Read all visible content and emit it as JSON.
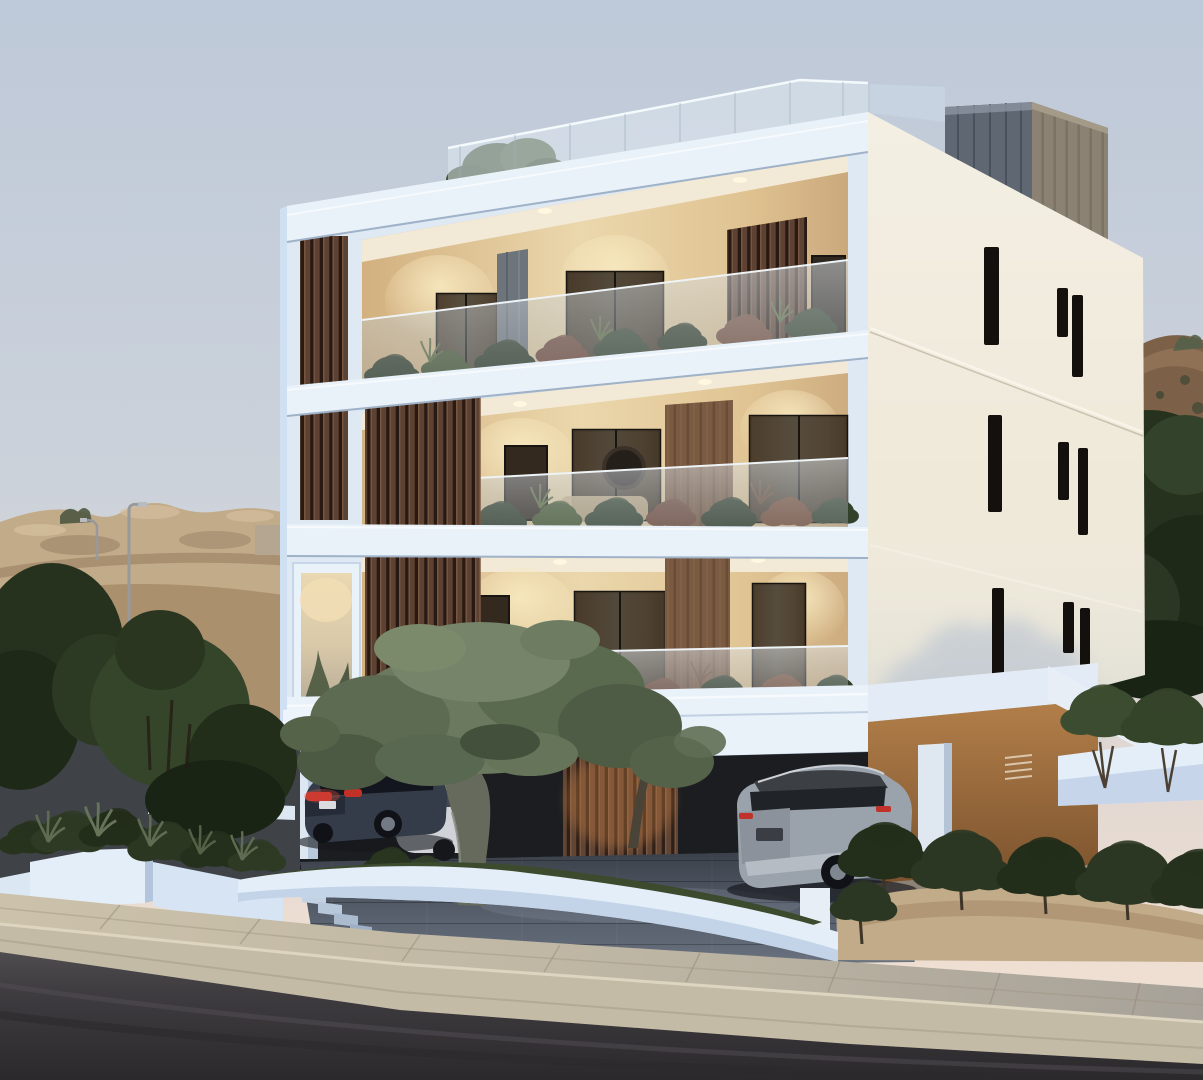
{
  "scene": {
    "type": "architectural-render",
    "description": "Dusk 3D rendering of a modern four-storey white apartment building with vertical wood-slat screens, warm-lit balconies with glass balustrades and planters, rooftop terrace with glass railing, ground-level carport with parked cars, an olive tree in a curved white planter, landscaped white retaining walls, a paved sidewalk and asphalt road on a sandy hillside.",
    "objects": [
      "apartment-building",
      "rooftop-glass-railing",
      "roof-stair-core",
      "wood-slat-screen",
      "balcony",
      "balustrade-glass",
      "balcony-plants",
      "frosted-entrance-window",
      "slit-windows",
      "carport",
      "dark-sedan",
      "white-car",
      "silver-suv",
      "olive-tree",
      "second-olive-tree",
      "white-planter-walls",
      "garden-steps",
      "street-lamp",
      "sandy-hillside",
      "rocky-hillside",
      "dark-green-trees",
      "shrub-row",
      "sand-mound",
      "sidewalk",
      "kerb",
      "asphalt-road",
      "paver-driveway"
    ]
  },
  "palette": {
    "sky_top": "#bec9d9",
    "sky_horizon": "#eedfd2",
    "facade_white": "#dfe9f4",
    "facade_band": "#e9f1f9",
    "facade_side": "#cfe0f2",
    "cream_face": "#efe9d9",
    "cream_shadow": "#b7c2d2",
    "wood_dark": "#503628",
    "wood_mid": "#6e4c38",
    "wood_pillar": "#7b5a42",
    "roofcore_front": "#5f6872",
    "roofcore_side": "#8a8172",
    "interior_wall": "#e7d2a6",
    "interior_ceiling": "#f2e9d6",
    "door_glass": "#2e2720",
    "door_frame": "#171411",
    "balustrade_glass": "#c9cfd4",
    "plant_green": "#2f3b26",
    "plant_green_light": "#4a5a38",
    "plant_dry": "#6f4534",
    "roof_tree": "#4a5a40",
    "hill_sand": "#c2ab89",
    "hill_rock": "#7c6148",
    "concrete_wall": "#b5a692",
    "tree_dark": "#26321e",
    "tree_mid": "#35452a",
    "olive_green": "#6b7a5e",
    "olive_dark": "#4e5c45",
    "olive_trunk": "#656a5c",
    "planter_white": "#e4eef9",
    "planter_shadow": "#b3c5dd",
    "grass_dark": "#3c4a2e",
    "carport_dark": "#1b1d20",
    "carport_warm": "#a8743f",
    "carport_floor": "#8c8276",
    "driveway": "#5e6775",
    "sidewalk_beige": "#ccc2ab",
    "sidewalk_grey": "#a7a299",
    "kerb": "#c4bba6",
    "road": "#3d3a3e",
    "car_dark": "#343c49",
    "car_silver": "#9aa2ac",
    "taillight_red": "#c23028",
    "plate_white": "#d9dbdf",
    "lamp_grey": "#97999c",
    "ground_dusk": "#3f4347"
  }
}
